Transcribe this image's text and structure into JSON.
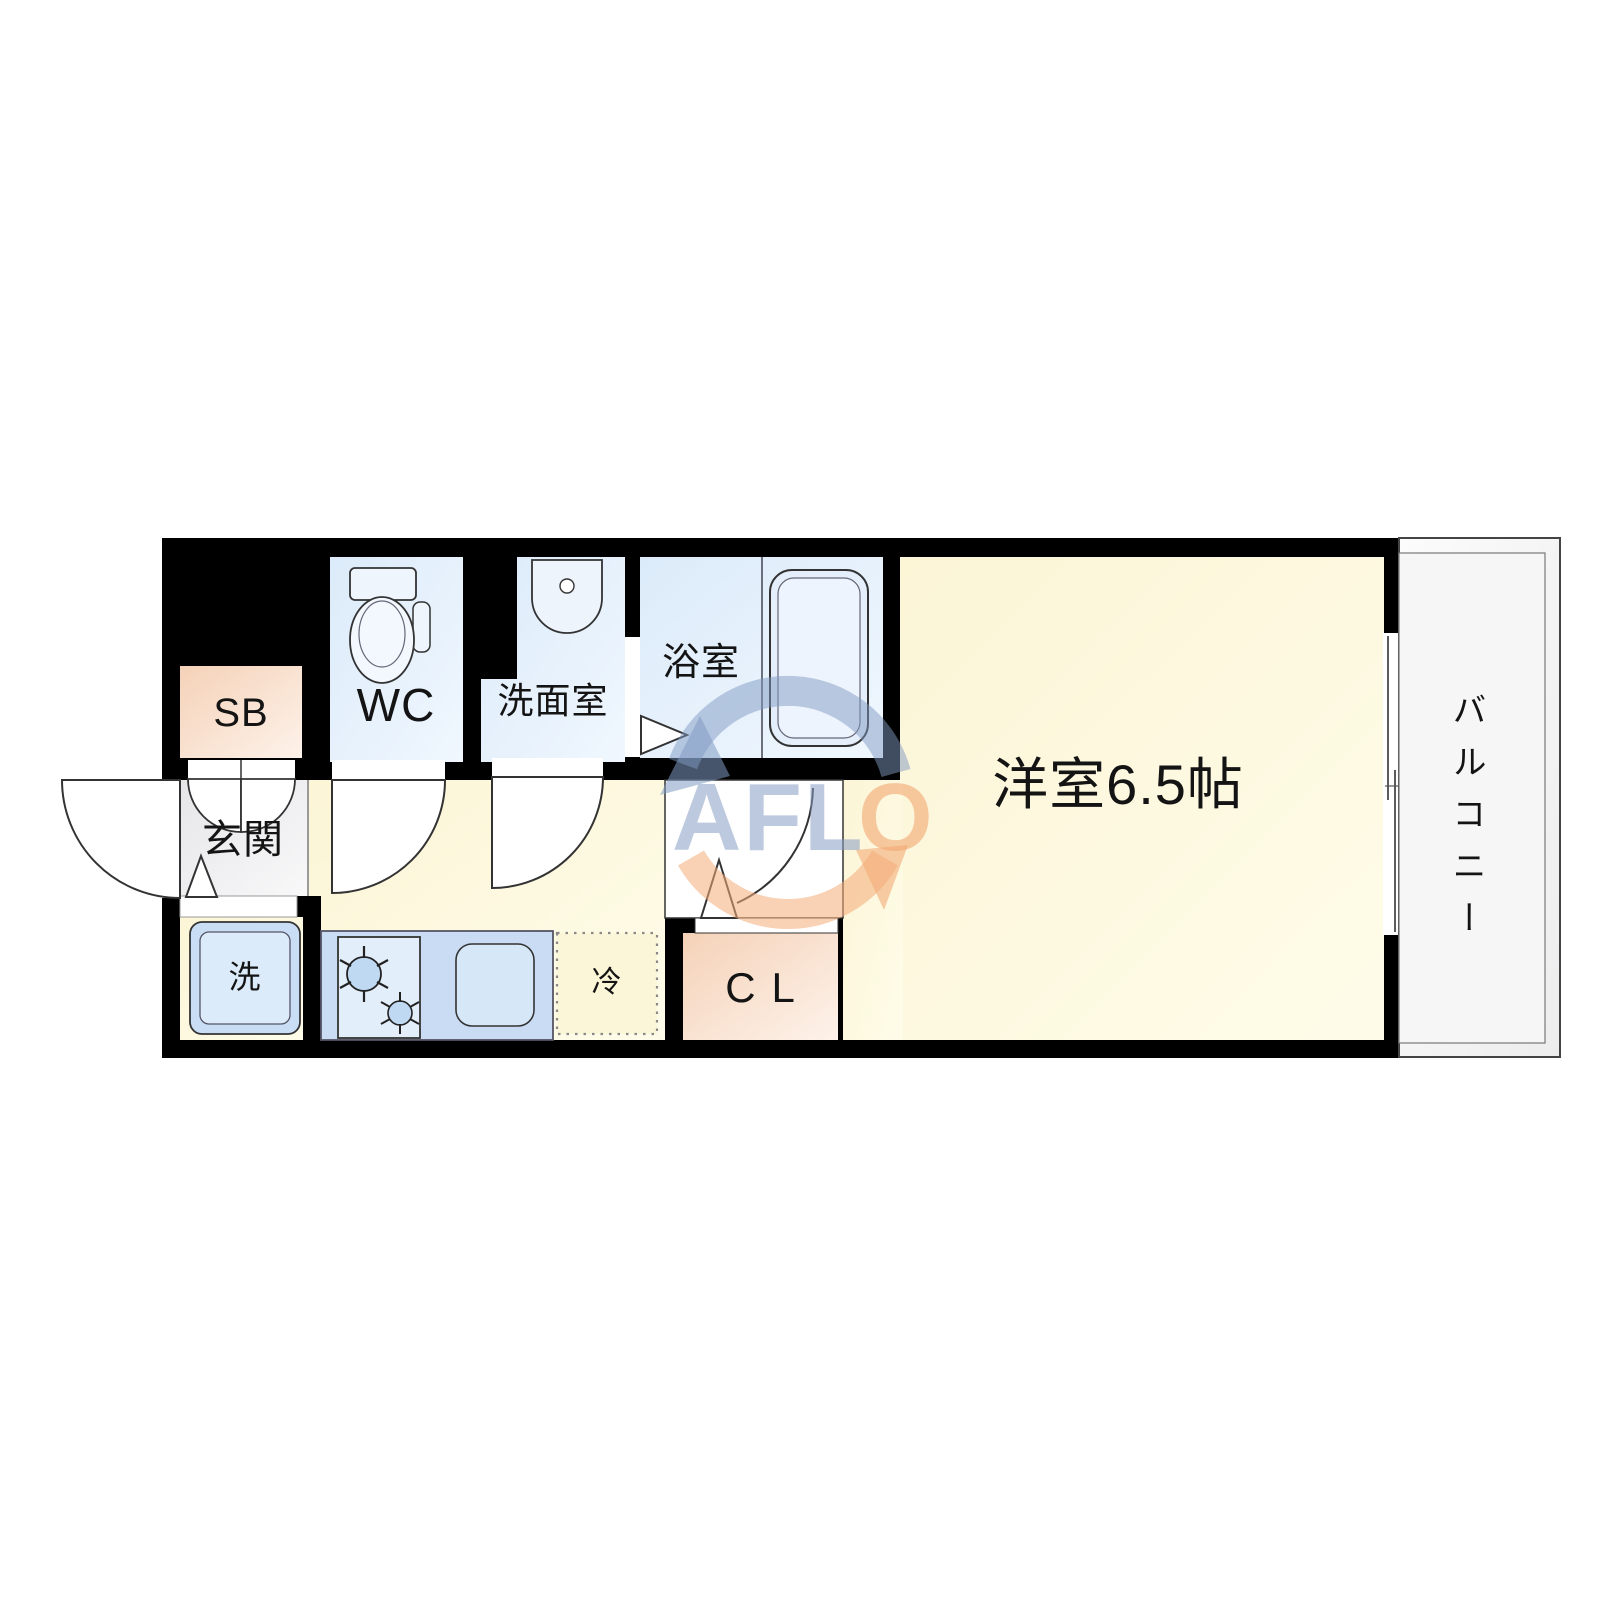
{
  "floorplan": {
    "rooms": {
      "shoe_box": {
        "label": "SB"
      },
      "toilet": {
        "label": "WC"
      },
      "washroom": {
        "label": "洗面室"
      },
      "bathroom": {
        "label": "浴室"
      },
      "entrance": {
        "label": "玄関"
      },
      "washing_machine": {
        "label": "洗"
      },
      "refrigerator": {
        "label": "冷"
      },
      "closet": {
        "label": "CL"
      },
      "western_room": {
        "label": "洋室6.5帖"
      },
      "balcony": {
        "label": "バルコニー"
      }
    },
    "watermark": {
      "text_primary": "AFL",
      "text_accent": "O"
    },
    "colors": {
      "wall_black": "#000000",
      "floor_cream": "#fdf8e0",
      "wet_area_blue": "#e3eefb",
      "accent_peach": "#f7d9c2",
      "entrance_gray": "#e9e9ec",
      "kitchen_counter_blue": "#c9dcf3",
      "balcony_white": "#f7f7f7",
      "watermark_blue": "#8ba0c6",
      "watermark_orange": "#f3aa72"
    }
  }
}
